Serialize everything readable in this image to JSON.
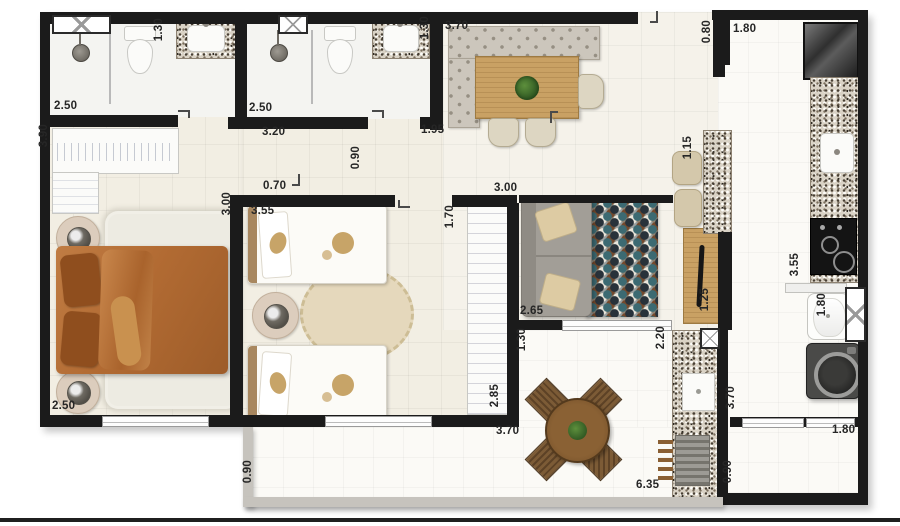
{
  "title": "apartment-floor-plan",
  "colors": {
    "wall": "#1b1b1b",
    "floor_main": "#f2eee3",
    "floor_white": "#fbfaf6",
    "granite": "#d9d2c5",
    "bed_orange": "#b26b33",
    "sofa_gray": "#a29e97",
    "rug_teal": "#3c6a72",
    "wood": "#c9a164",
    "label_text": "#262626"
  },
  "dimension_labels": [
    {
      "text": "2.50",
      "x": 54,
      "y": 100,
      "v": false
    },
    {
      "text": "1.30",
      "x": 153,
      "y": 18,
      "v": true
    },
    {
      "text": "2.50",
      "x": 249,
      "y": 102,
      "v": false
    },
    {
      "text": "1.30",
      "x": 419,
      "y": 16,
      "v": true
    },
    {
      "text": "3.20",
      "x": 262,
      "y": 126,
      "v": false
    },
    {
      "text": "1.95",
      "x": 421,
      "y": 124,
      "v": false
    },
    {
      "text": "3.70",
      "x": 445,
      "y": 20,
      "v": false
    },
    {
      "text": "0.80",
      "x": 701,
      "y": 20,
      "v": true
    },
    {
      "text": "1.80",
      "x": 733,
      "y": 23,
      "v": false
    },
    {
      "text": "3.90",
      "x": 38,
      "y": 124,
      "v": true
    },
    {
      "text": "0.90",
      "x": 350,
      "y": 146,
      "v": true
    },
    {
      "text": "0.70",
      "x": 263,
      "y": 180,
      "v": false
    },
    {
      "text": "3.00",
      "x": 221,
      "y": 192,
      "v": true
    },
    {
      "text": "3.55",
      "x": 251,
      "y": 205,
      "v": false
    },
    {
      "text": "3.00",
      "x": 494,
      "y": 182,
      "v": false
    },
    {
      "text": "1.70",
      "x": 444,
      "y": 205,
      "v": true
    },
    {
      "text": "1.15",
      "x": 682,
      "y": 136,
      "v": true
    },
    {
      "text": "2.65",
      "x": 520,
      "y": 305,
      "v": false
    },
    {
      "text": "1.25",
      "x": 699,
      "y": 288,
      "v": true
    },
    {
      "text": "3.55",
      "x": 789,
      "y": 253,
      "v": true
    },
    {
      "text": "1.80",
      "x": 816,
      "y": 293,
      "v": true
    },
    {
      "text": "2.50",
      "x": 52,
      "y": 400,
      "v": false
    },
    {
      "text": "1.30",
      "x": 516,
      "y": 328,
      "v": true
    },
    {
      "text": "2.20",
      "x": 655,
      "y": 326,
      "v": true
    },
    {
      "text": "2.85",
      "x": 489,
      "y": 384,
      "v": true
    },
    {
      "text": "3.70",
      "x": 496,
      "y": 425,
      "v": false
    },
    {
      "text": "3.70",
      "x": 725,
      "y": 386,
      "v": true
    },
    {
      "text": "6.35",
      "x": 636,
      "y": 479,
      "v": false
    },
    {
      "text": "0.90",
      "x": 242,
      "y": 460,
      "v": true
    },
    {
      "text": "0.90",
      "x": 722,
      "y": 460,
      "v": true
    },
    {
      "text": "1.80",
      "x": 832,
      "y": 424,
      "v": false
    }
  ]
}
